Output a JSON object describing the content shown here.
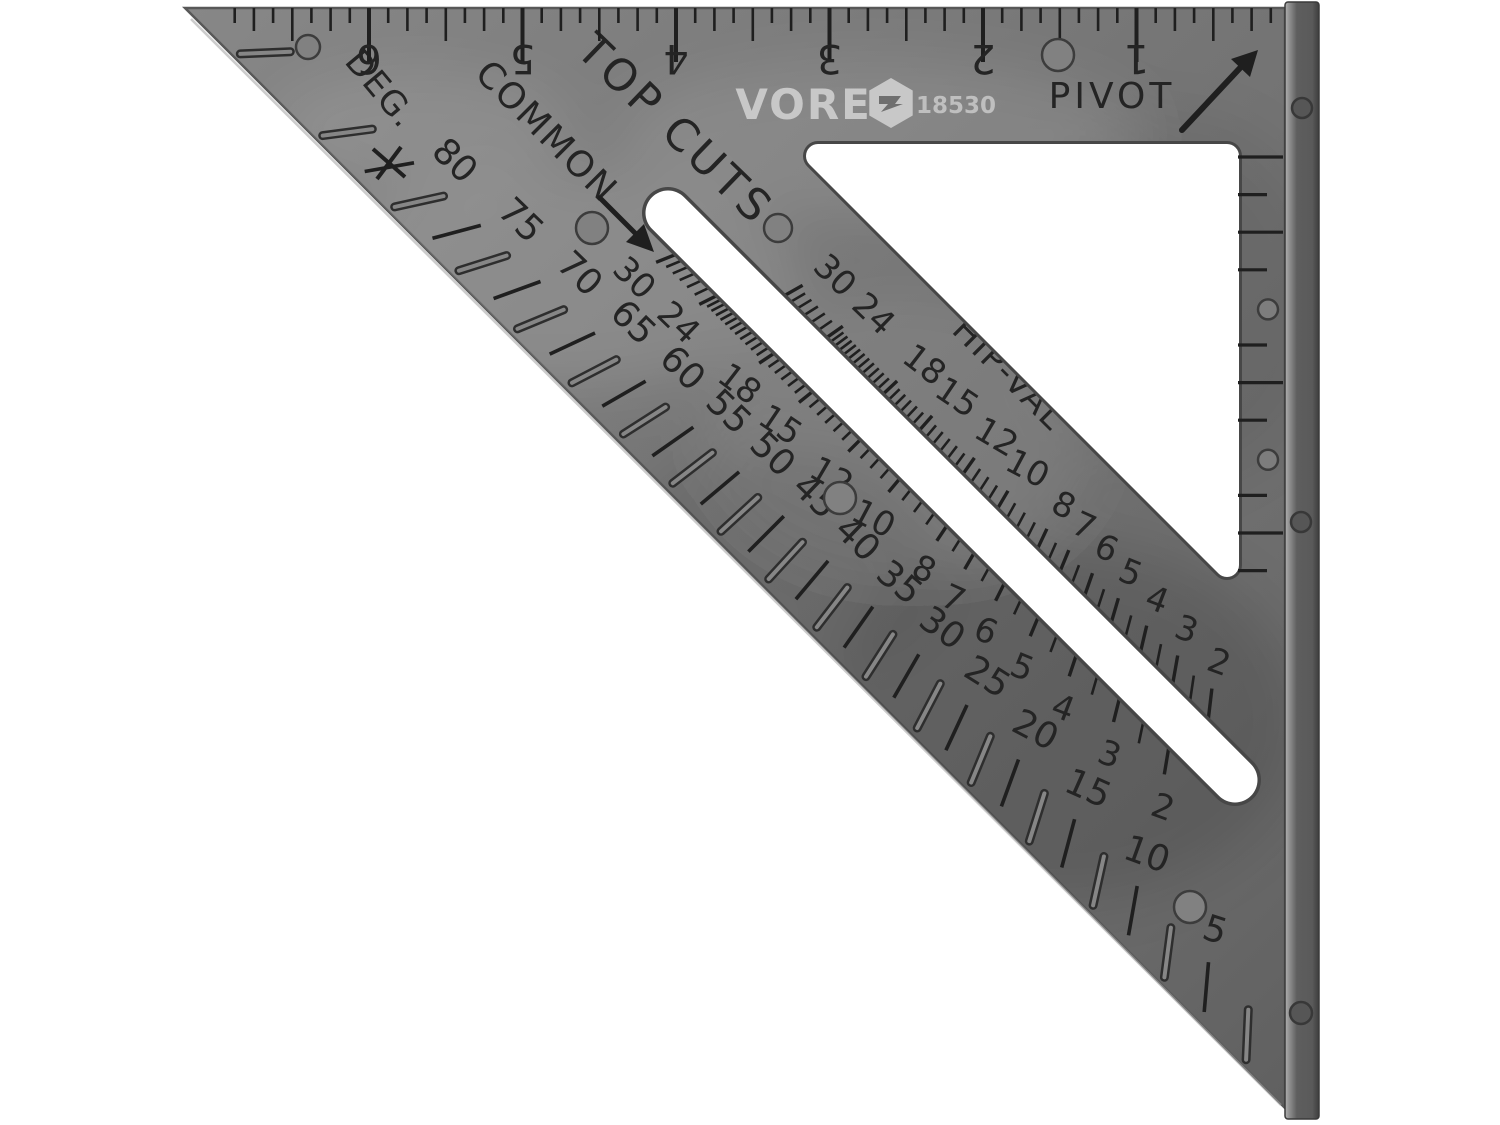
{
  "image_type": "product-photo",
  "subject": "black plastic rafter speed square with raised fence lip, photographed on white",
  "brand": {
    "name": "VOREL",
    "model": "18530"
  },
  "labels": {
    "pivot": "PIVOT",
    "deg": "DEG.",
    "common": "COMMON",
    "top_cuts": "TOP CUTS",
    "hip_val": "HIP-VAL"
  },
  "scales": {
    "inch_ruler": {
      "numbers": [
        "1",
        "2",
        "3",
        "4",
        "5",
        "6"
      ],
      "orientation": "upside-down along top edge"
    },
    "degrees": {
      "values": [
        80,
        75,
        70,
        65,
        60,
        55,
        50,
        45,
        40,
        35,
        30,
        25,
        20,
        15,
        10,
        5
      ]
    },
    "common_rafter": {
      "values": [
        30,
        24,
        18,
        15,
        12,
        10,
        8,
        7,
        6,
        5,
        4,
        3,
        2
      ]
    },
    "hip_valley_rafter": {
      "values": [
        30,
        24,
        18,
        15,
        12,
        10,
        8,
        7,
        6,
        5,
        4,
        3,
        2
      ]
    }
  },
  "colors": {
    "body": "#767676",
    "body_dark": "#636363",
    "engraving": "#242424",
    "tick": "#1f1f1f",
    "logo_light": "#c8c8c8",
    "flange_light": "#a6a6a6",
    "flange_dark": "#4a4a4a",
    "background": "#ffffff",
    "cutout": "#ffffff"
  }
}
